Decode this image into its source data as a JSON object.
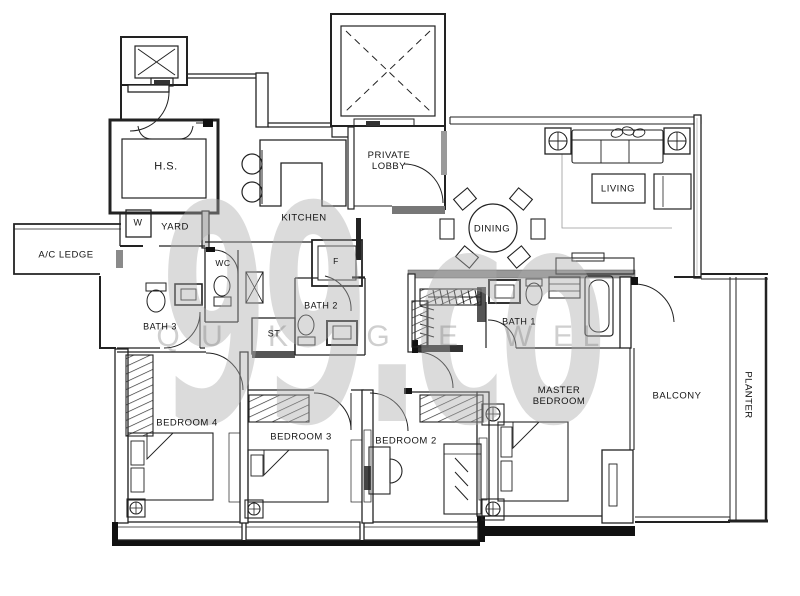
{
  "page": {
    "background": "#ffffff",
    "line_color": "#222222"
  },
  "watermark": {
    "brand": "99.co",
    "brand_color": "#ababab",
    "tagline_letters": [
      {
        "ch": "Q",
        "x": 168,
        "y": 337
      },
      {
        "ch": "U",
        "x": 212,
        "y": 337
      },
      {
        "ch": "K",
        "x": 278,
        "y": 337
      },
      {
        "ch": "G",
        "x": 378,
        "y": 337
      },
      {
        "ch": "E",
        "x": 448,
        "y": 337
      },
      {
        "ch": "W",
        "x": 518,
        "y": 337
      },
      {
        "ch": "E",
        "x": 563,
        "y": 337
      },
      {
        "ch": "L",
        "x": 591,
        "y": 337
      }
    ]
  },
  "rooms": [
    {
      "id": "hs",
      "label": "H.S.",
      "x": 166,
      "y": 167,
      "fs": 11
    },
    {
      "id": "w-washer",
      "label": "W",
      "x": 138,
      "y": 223,
      "fs": 9
    },
    {
      "id": "yard",
      "label": "YARD",
      "x": 175,
      "y": 227,
      "fs": 9.5
    },
    {
      "id": "ac-ledge",
      "label": "A/C LEDGE",
      "x": 66,
      "y": 255,
      "fs": 9.5
    },
    {
      "id": "kitchen",
      "label": "KITCHEN",
      "x": 304,
      "y": 218,
      "fs": 9.5
    },
    {
      "id": "private-lobby",
      "label": "PRIVATE\nLOBBY",
      "x": 389,
      "y": 161,
      "fs": 9.5
    },
    {
      "id": "wc",
      "label": "WC",
      "x": 223,
      "y": 263,
      "fs": 8.5
    },
    {
      "id": "fridge",
      "label": "F",
      "x": 336,
      "y": 261,
      "fs": 8.5
    },
    {
      "id": "dining",
      "label": "DINING",
      "x": 492,
      "y": 229,
      "fs": 9.5
    },
    {
      "id": "living",
      "label": "LIVING",
      "x": 618,
      "y": 189,
      "fs": 9.5
    },
    {
      "id": "bath2",
      "label": "BATH 2",
      "x": 321,
      "y": 306,
      "fs": 9
    },
    {
      "id": "st",
      "label": "ST",
      "x": 274,
      "y": 334,
      "fs": 9
    },
    {
      "id": "bath3",
      "label": "BATH 3",
      "x": 160,
      "y": 327,
      "fs": 9
    },
    {
      "id": "bath1",
      "label": "BATH 1",
      "x": 519,
      "y": 322,
      "fs": 9
    },
    {
      "id": "master-bedroom",
      "label": "MASTER\nBEDROOM",
      "x": 559,
      "y": 396,
      "fs": 9.5
    },
    {
      "id": "balcony",
      "label": "BALCONY",
      "x": 677,
      "y": 396,
      "fs": 9.5
    },
    {
      "id": "planter",
      "label": "PLANTER",
      "x": 748,
      "y": 395,
      "fs": 9.5,
      "rot": 90
    },
    {
      "id": "bedroom4",
      "label": "BEDROOM 4",
      "x": 187,
      "y": 423,
      "fs": 9.5
    },
    {
      "id": "bedroom3",
      "label": "BEDROOM 3",
      "x": 301,
      "y": 437,
      "fs": 9.5
    },
    {
      "id": "bedroom2",
      "label": "BEDROOM 2",
      "x": 406,
      "y": 441,
      "fs": 9.5
    }
  ]
}
